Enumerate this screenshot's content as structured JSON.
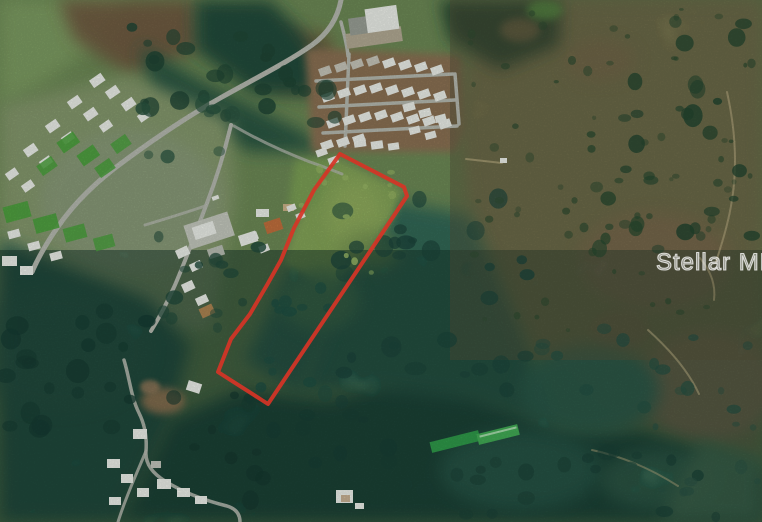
{
  "watermark": {
    "text": "Stellar MLS",
    "color": "#ffffff"
  },
  "map": {
    "type": "satellite-aerial-photo",
    "boundary_color": "#d63426",
    "boundary_shape": "elongated-parcel-outline"
  }
}
